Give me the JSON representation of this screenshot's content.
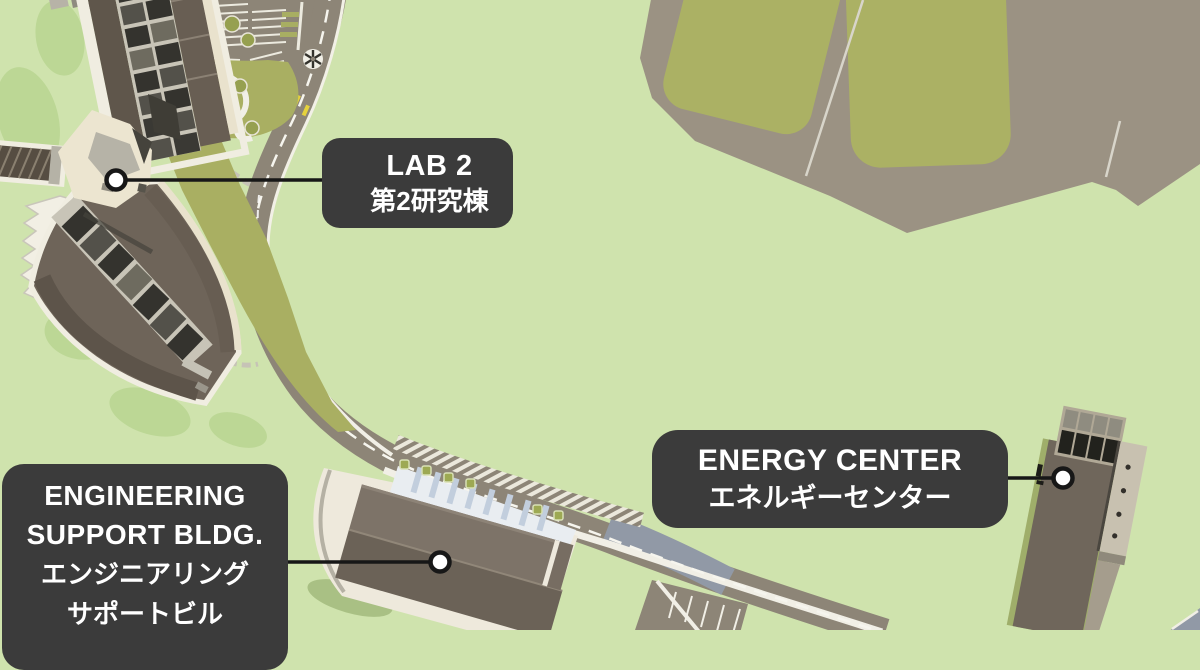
{
  "map": {
    "type": "illustrated campus map",
    "colors": {
      "background_green": "#cfe3ad",
      "label_background": "#3b3b3b",
      "label_text": "#ffffff",
      "road_taupe": "#8d8577",
      "bridge_blue_gray": "#9199a6",
      "field_olive": "#a9af62",
      "ground_taupe": "#9b9283",
      "roof_dark_brown": "#5f564b",
      "roof_mid_brown": "#6e6459",
      "apron_cream": "#ece5d0",
      "callout_line": "#171717"
    }
  },
  "labels": {
    "lab2": {
      "en": "LAB 2",
      "ja": "第2研究棟"
    },
    "energy_center": {
      "en": "ENERGY CENTER",
      "ja": "エネルギーセンター"
    },
    "engineering_support": {
      "en_line1": "ENGINEERING",
      "en_line2": "SUPPORT BLDG.",
      "ja_line1": "エンジニアリング",
      "ja_line2": "サポートビル"
    }
  },
  "callouts": [
    {
      "target": "lab-2-building"
    },
    {
      "target": "engineering-support-building"
    },
    {
      "target": "energy-center-building"
    }
  ]
}
